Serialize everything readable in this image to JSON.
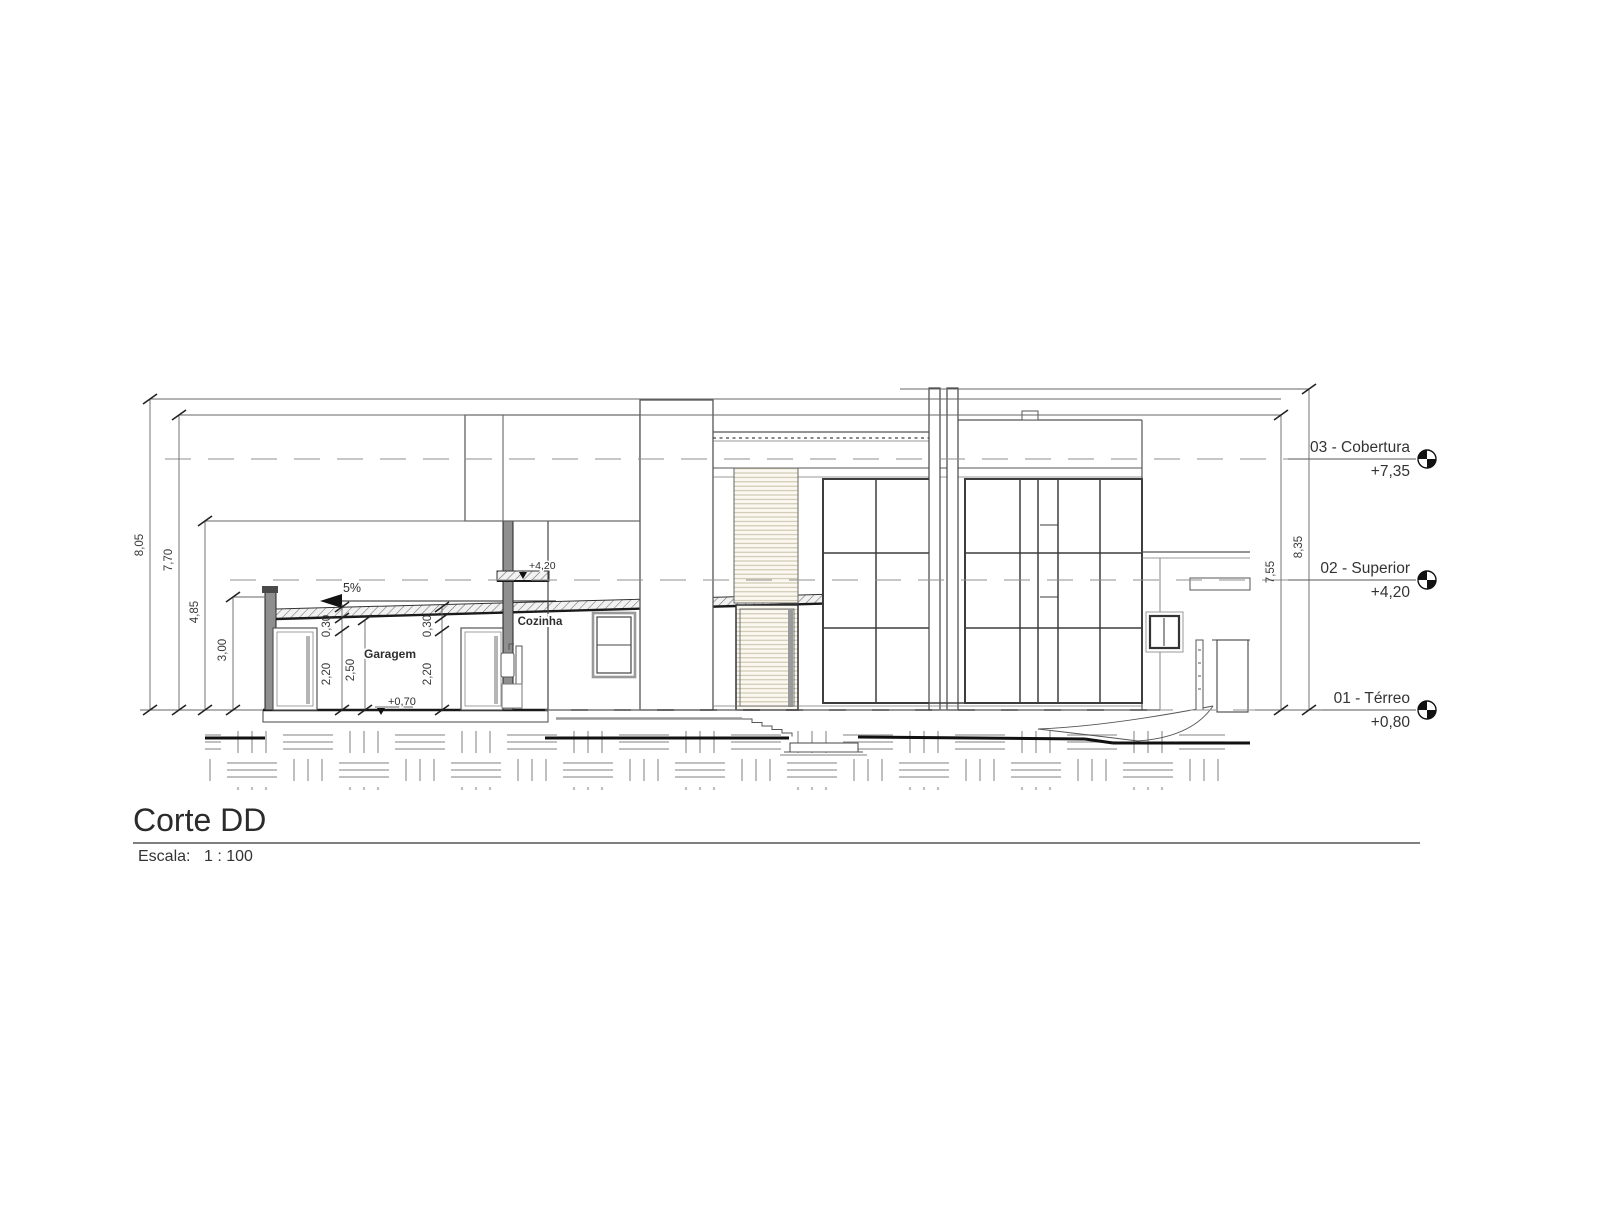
{
  "drawing": {
    "title": "Corte DD",
    "scale_label": "Escala:",
    "scale_value": "1 : 100"
  },
  "levels": [
    {
      "name": "03 - Cobertura",
      "elevation": "+7,35"
    },
    {
      "name": "02 - Superior",
      "elevation": "+4,20"
    },
    {
      "name": "01 - Térreo",
      "elevation": "+0,80"
    }
  ],
  "dims": {
    "left": [
      "8,05",
      "7,70",
      "4,85",
      "3,00"
    ],
    "right": [
      "7,55",
      "8,35"
    ],
    "garage": {
      "slab_left": "0,30",
      "slab_right": "0,30",
      "door_left": "2,20",
      "clear": "2,50",
      "door_right": "2,20"
    }
  },
  "annotations": {
    "slope": "5%",
    "garage_room": "Garagem",
    "kitchen_room": "Cozinha",
    "floor_spot": "+0,70",
    "slab_spot": "+4,20"
  },
  "colors": {
    "cut_wall": "#8f8f8f",
    "line_dark": "#222222",
    "line_mid": "#555555",
    "hatch_gray": "#9a9a9a",
    "louver_tint": "#c8bfa2"
  }
}
